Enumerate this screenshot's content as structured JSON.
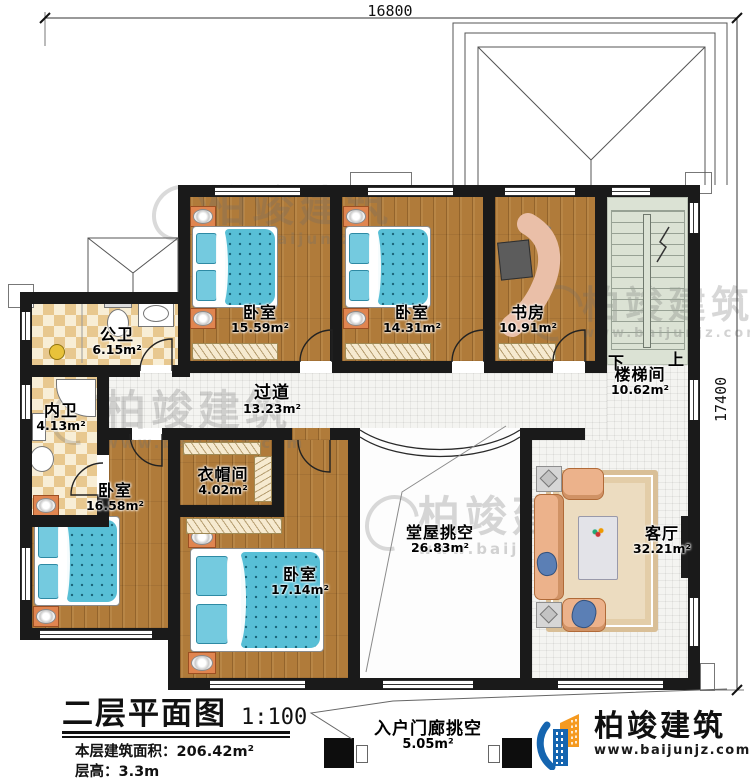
{
  "plan": {
    "dim_top": "16800",
    "dim_right": "17400"
  },
  "rooms": {
    "bedroom1": {
      "name": "卧室",
      "area": "15.59m²"
    },
    "bedroom2": {
      "name": "卧室",
      "area": "14.31m²"
    },
    "study": {
      "name": "书房",
      "area": "10.91m²"
    },
    "stairwell": {
      "name": "楼梯间",
      "area": "10.62m²"
    },
    "public_bath": {
      "name": "公卫",
      "area": "6.15m²"
    },
    "private_bath": {
      "name": "内卫",
      "area": "4.13m²"
    },
    "corridor": {
      "name": "过道",
      "area": "13.23m²"
    },
    "cloakroom": {
      "name": "衣帽间",
      "area": "4.02m²"
    },
    "bedroom3": {
      "name": "卧室",
      "area": "16.58m²"
    },
    "bedroom4": {
      "name": "卧室",
      "area": "17.14m²"
    },
    "hall_void": {
      "name": "堂屋挑空",
      "area": "26.83m²"
    },
    "living_room": {
      "name": "客厅",
      "area": "32.21m²"
    },
    "entry_porch_void": {
      "name": "入户门廊挑空",
      "area": "5.05m²"
    }
  },
  "stairs": {
    "down_label": "下",
    "up_label": "上"
  },
  "title_block": {
    "title": "二层平面图",
    "scale": "1:100",
    "area_label": "本层建筑面积：",
    "area_value": "206.42m²",
    "floor_height_label": "层高：",
    "floor_height_value": "3.3m"
  },
  "branding": {
    "company": "柏竣建筑",
    "website": "www.baijunjz.com"
  },
  "watermark": {
    "text": "柏竣建筑",
    "website": "www.baijunjz.com"
  },
  "colors": {
    "wall": "#1a1a1a",
    "wood_floor": "#b07b3a",
    "bed_blue": "#58bfd6",
    "logo_blue": "#1565b0",
    "logo_orange": "#f59a20"
  }
}
